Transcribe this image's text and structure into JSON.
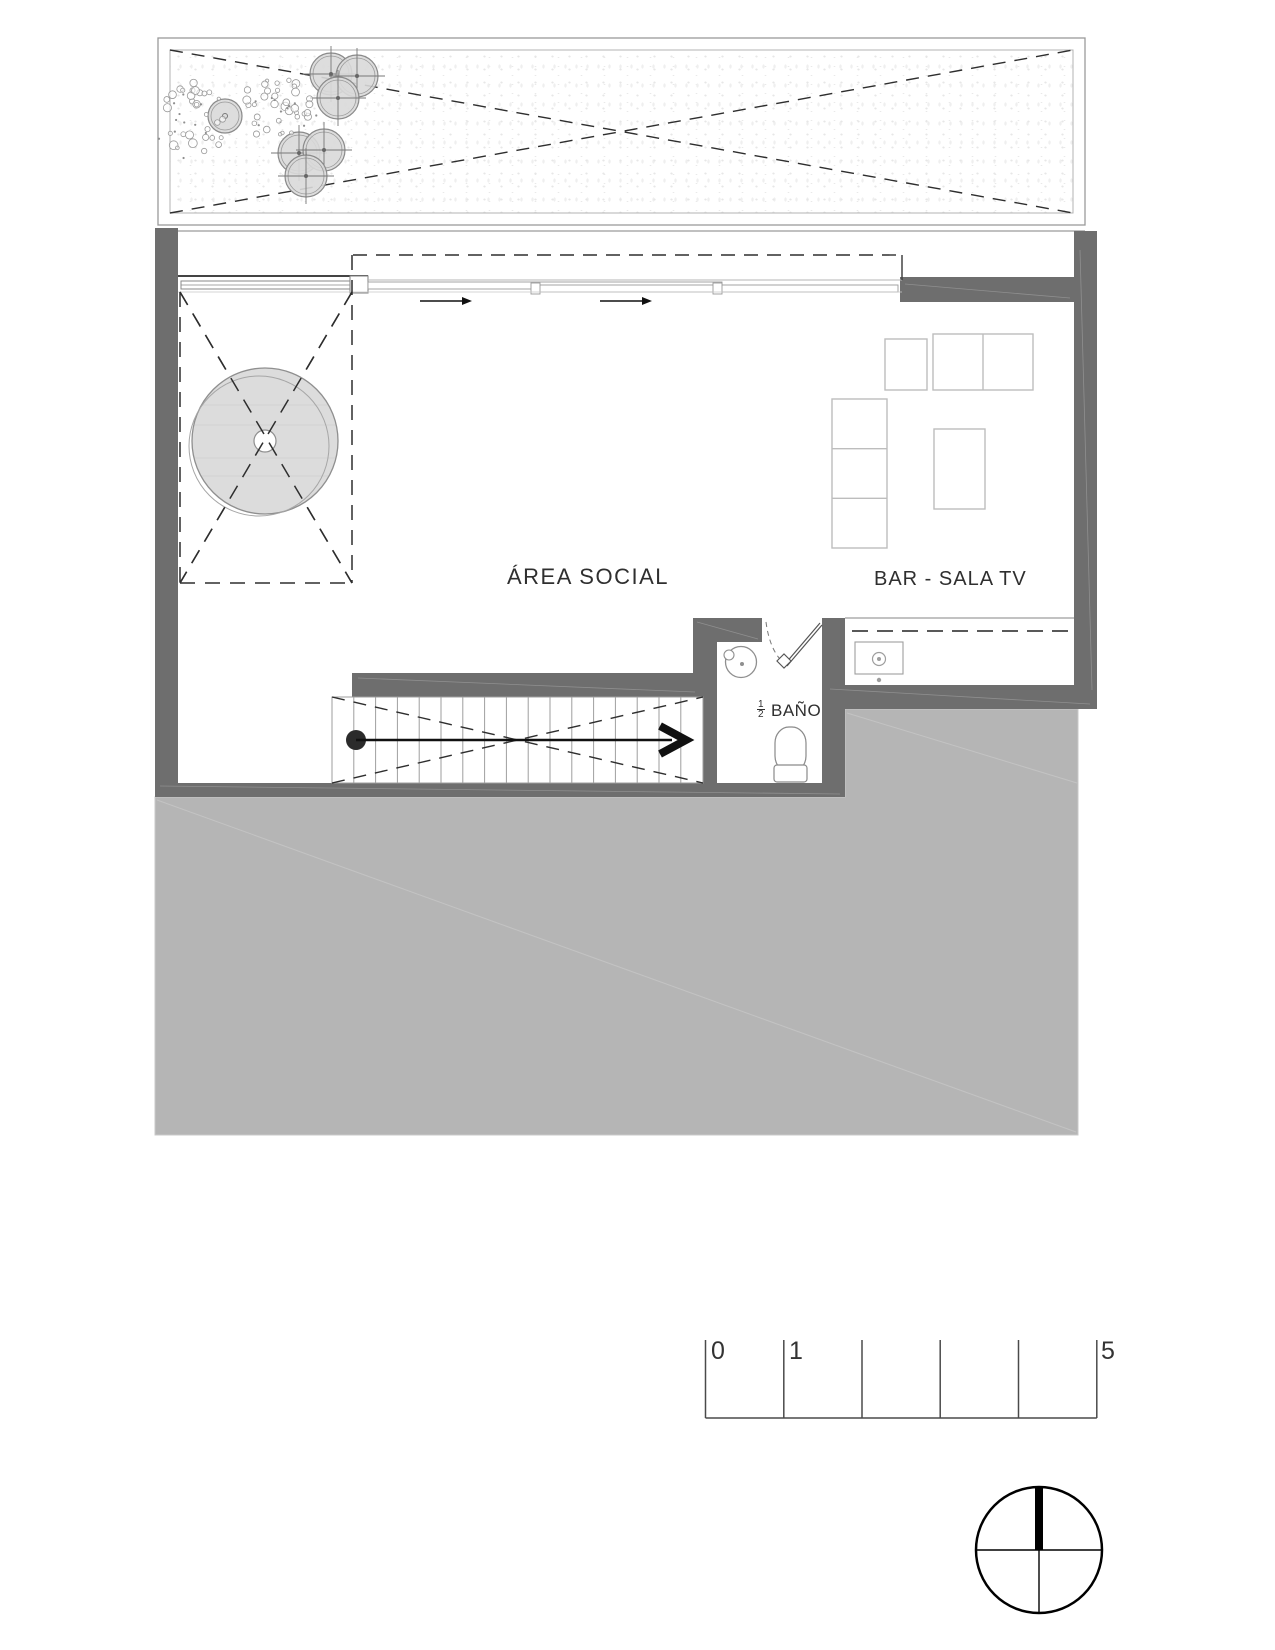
{
  "labels": {
    "area_social": "ÁREA SOCIAL",
    "bar_sala_tv": "BAR - SALA TV",
    "bano": "BAÑO",
    "bano_fraction_num": "1",
    "bano_fraction_den": "2"
  },
  "scale_bar": {
    "tick_first": "0",
    "tick_second": "1",
    "tick_last": "5"
  },
  "colors": {
    "wall": "#6e6e6e",
    "slab": "#b5b5b5",
    "tree_fill": "#d9d9d9",
    "furniture_outline": "#bdbdbd",
    "ink": "#2e2e2e"
  },
  "icons": {
    "north_indicator": "compass-north-icon"
  }
}
